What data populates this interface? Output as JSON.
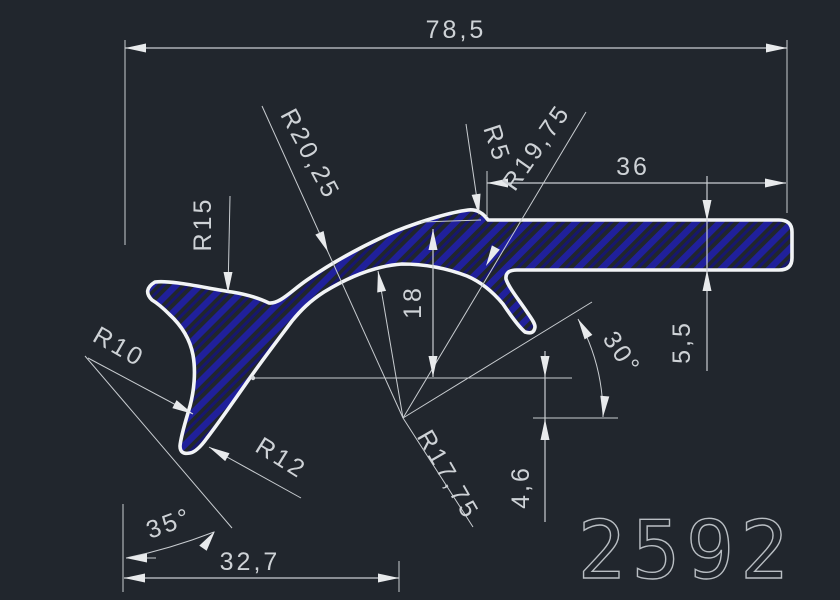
{
  "drawing": {
    "part_number": "2592",
    "colors": {
      "background": "#21262d",
      "lines": "#c9cdd1",
      "profile_outline": "#f2f4f6",
      "hatch": "#20209b",
      "text": "#ced2d6"
    },
    "dimensions": {
      "total_width": "78,5",
      "bar_length": "36",
      "arch_height": "18",
      "bar_thickness": "5,5",
      "vertex_offset": "4,6",
      "left_length": "32,7",
      "leg_angle": "35°",
      "hook_angle": "30°",
      "radius_5": "R5",
      "radius_10": "R10",
      "radius_12": "R12",
      "radius_15": "R15",
      "radius_17_75": "R17,75",
      "radius_19_75": "R19,75",
      "radius_20_25": "R20,25"
    }
  }
}
